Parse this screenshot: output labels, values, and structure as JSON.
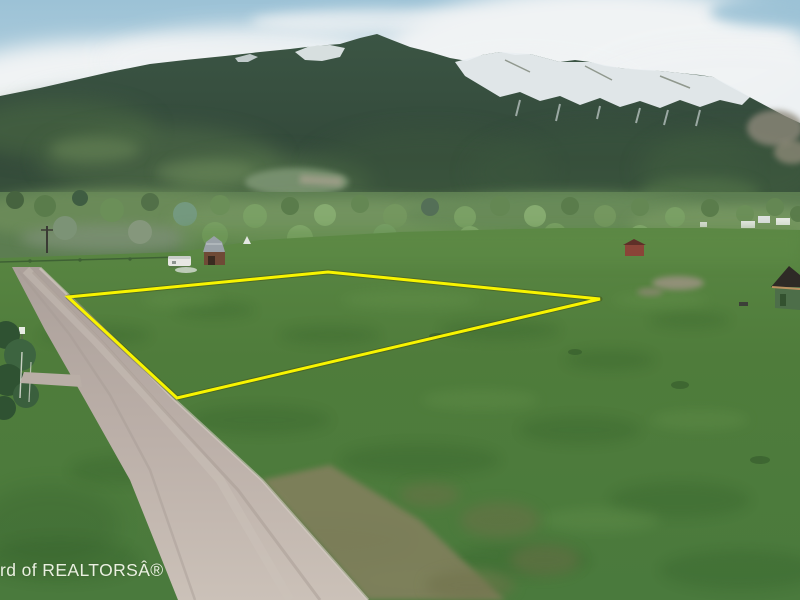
{
  "meta": {
    "kind": "aerial-drone-real-estate-photo",
    "width": 800,
    "height": 600,
    "alt": "Aerial photo of a vacant grass parcel outlined in yellow beside a gravel road, with tree line, pastures and snow-capped mountains behind"
  },
  "watermark": {
    "text": "rd of REALTORSÂ®",
    "color": "#f3f7ea"
  },
  "property_boundary": {
    "color": "#f8f400",
    "shadow_color": "#3c3c00",
    "stroke_width": 3,
    "points": "68,297 328,272 600,299 177,398"
  },
  "scene": {
    "sky_blue": "#a3c6d8",
    "cloud_white": "#f0f3f4",
    "mountain_forest": "#35503f",
    "snow_white": "#e9eef1",
    "scree_gray": "#8d887a",
    "tree_band_green": "#5c7d51",
    "field_green": "#4f7c3b",
    "road_gray": "#bbafa8",
    "worn_ground_brown": "#817c5c",
    "structures": [
      {
        "name": "gray-roof-barn"
      },
      {
        "name": "white-rv-trailer"
      },
      {
        "name": "white-teepee-tent"
      },
      {
        "name": "red-shed"
      },
      {
        "name": "white-farm-houses"
      },
      {
        "name": "brown-roof-cabin"
      },
      {
        "name": "power-pole"
      },
      {
        "name": "white-sign"
      }
    ]
  }
}
